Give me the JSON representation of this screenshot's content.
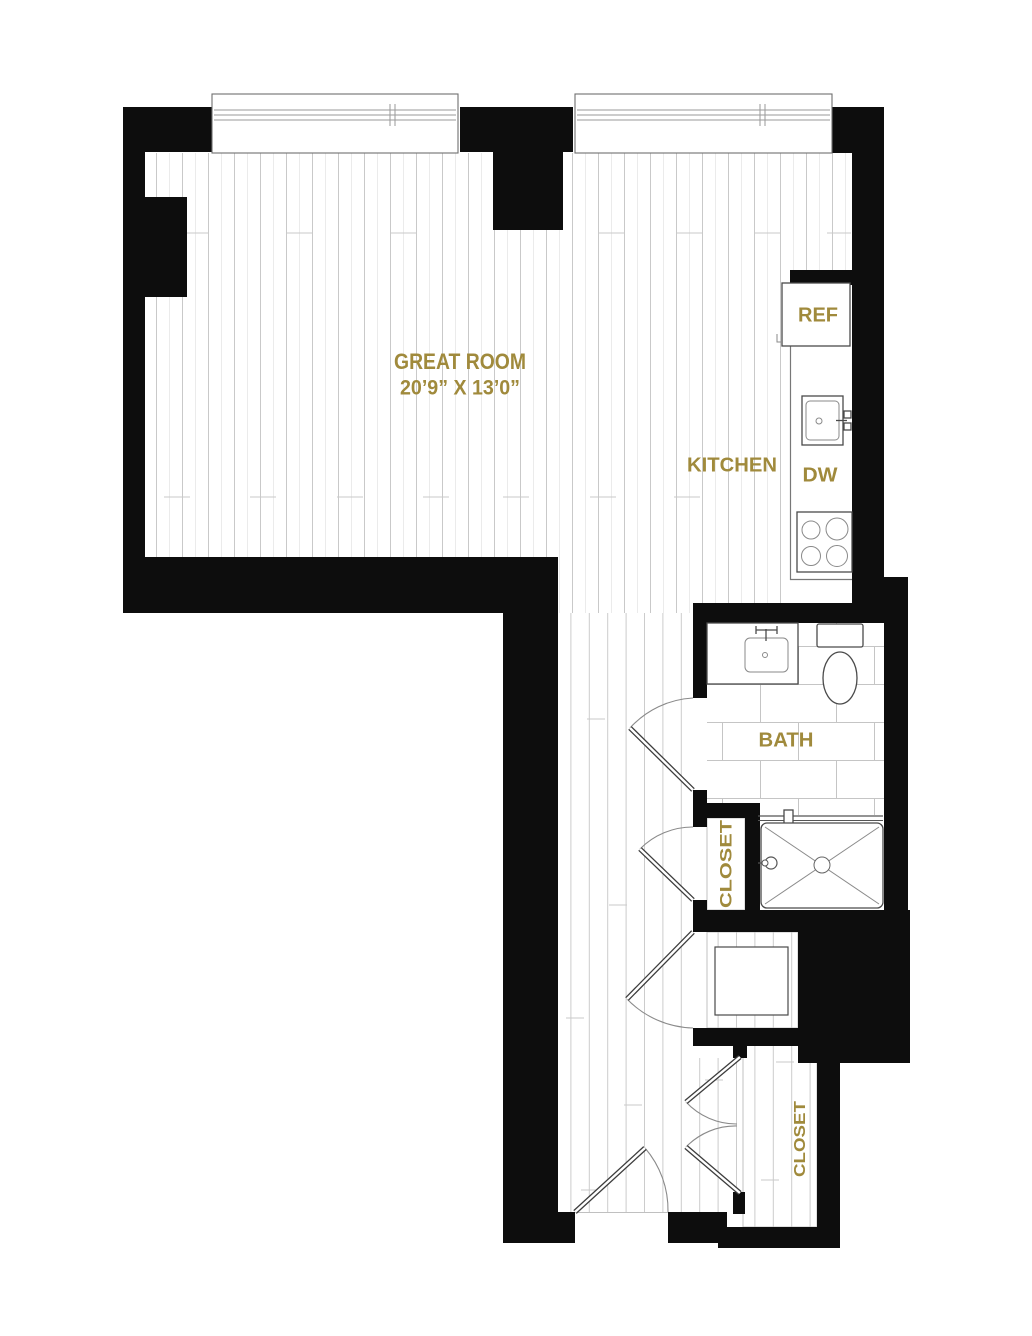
{
  "floor_plan": {
    "background": "#ffffff",
    "colors": {
      "wall": "#0d0d0d",
      "label": "#a08a3c",
      "fixture_line": "#4a4a4a",
      "floor_line": "#c9c9c9",
      "tile_line": "#c5c5c5",
      "door_arc": "#8a8a8a"
    },
    "rooms": [
      {
        "id": "great-room",
        "label": "GREAT ROOM",
        "dimensions": "20’9” X 13’0”"
      },
      {
        "id": "kitchen",
        "label": "KITCHEN"
      },
      {
        "id": "bath",
        "label": "BATH"
      },
      {
        "id": "hall-closet",
        "label": "CLOSET"
      },
      {
        "id": "entry-closet",
        "label": "CLOSET"
      },
      {
        "id": "laundry",
        "label": "W/D"
      }
    ],
    "appliances": [
      {
        "id": "refrigerator",
        "label": "REF"
      },
      {
        "id": "dishwasher",
        "label": "DW"
      }
    ]
  }
}
